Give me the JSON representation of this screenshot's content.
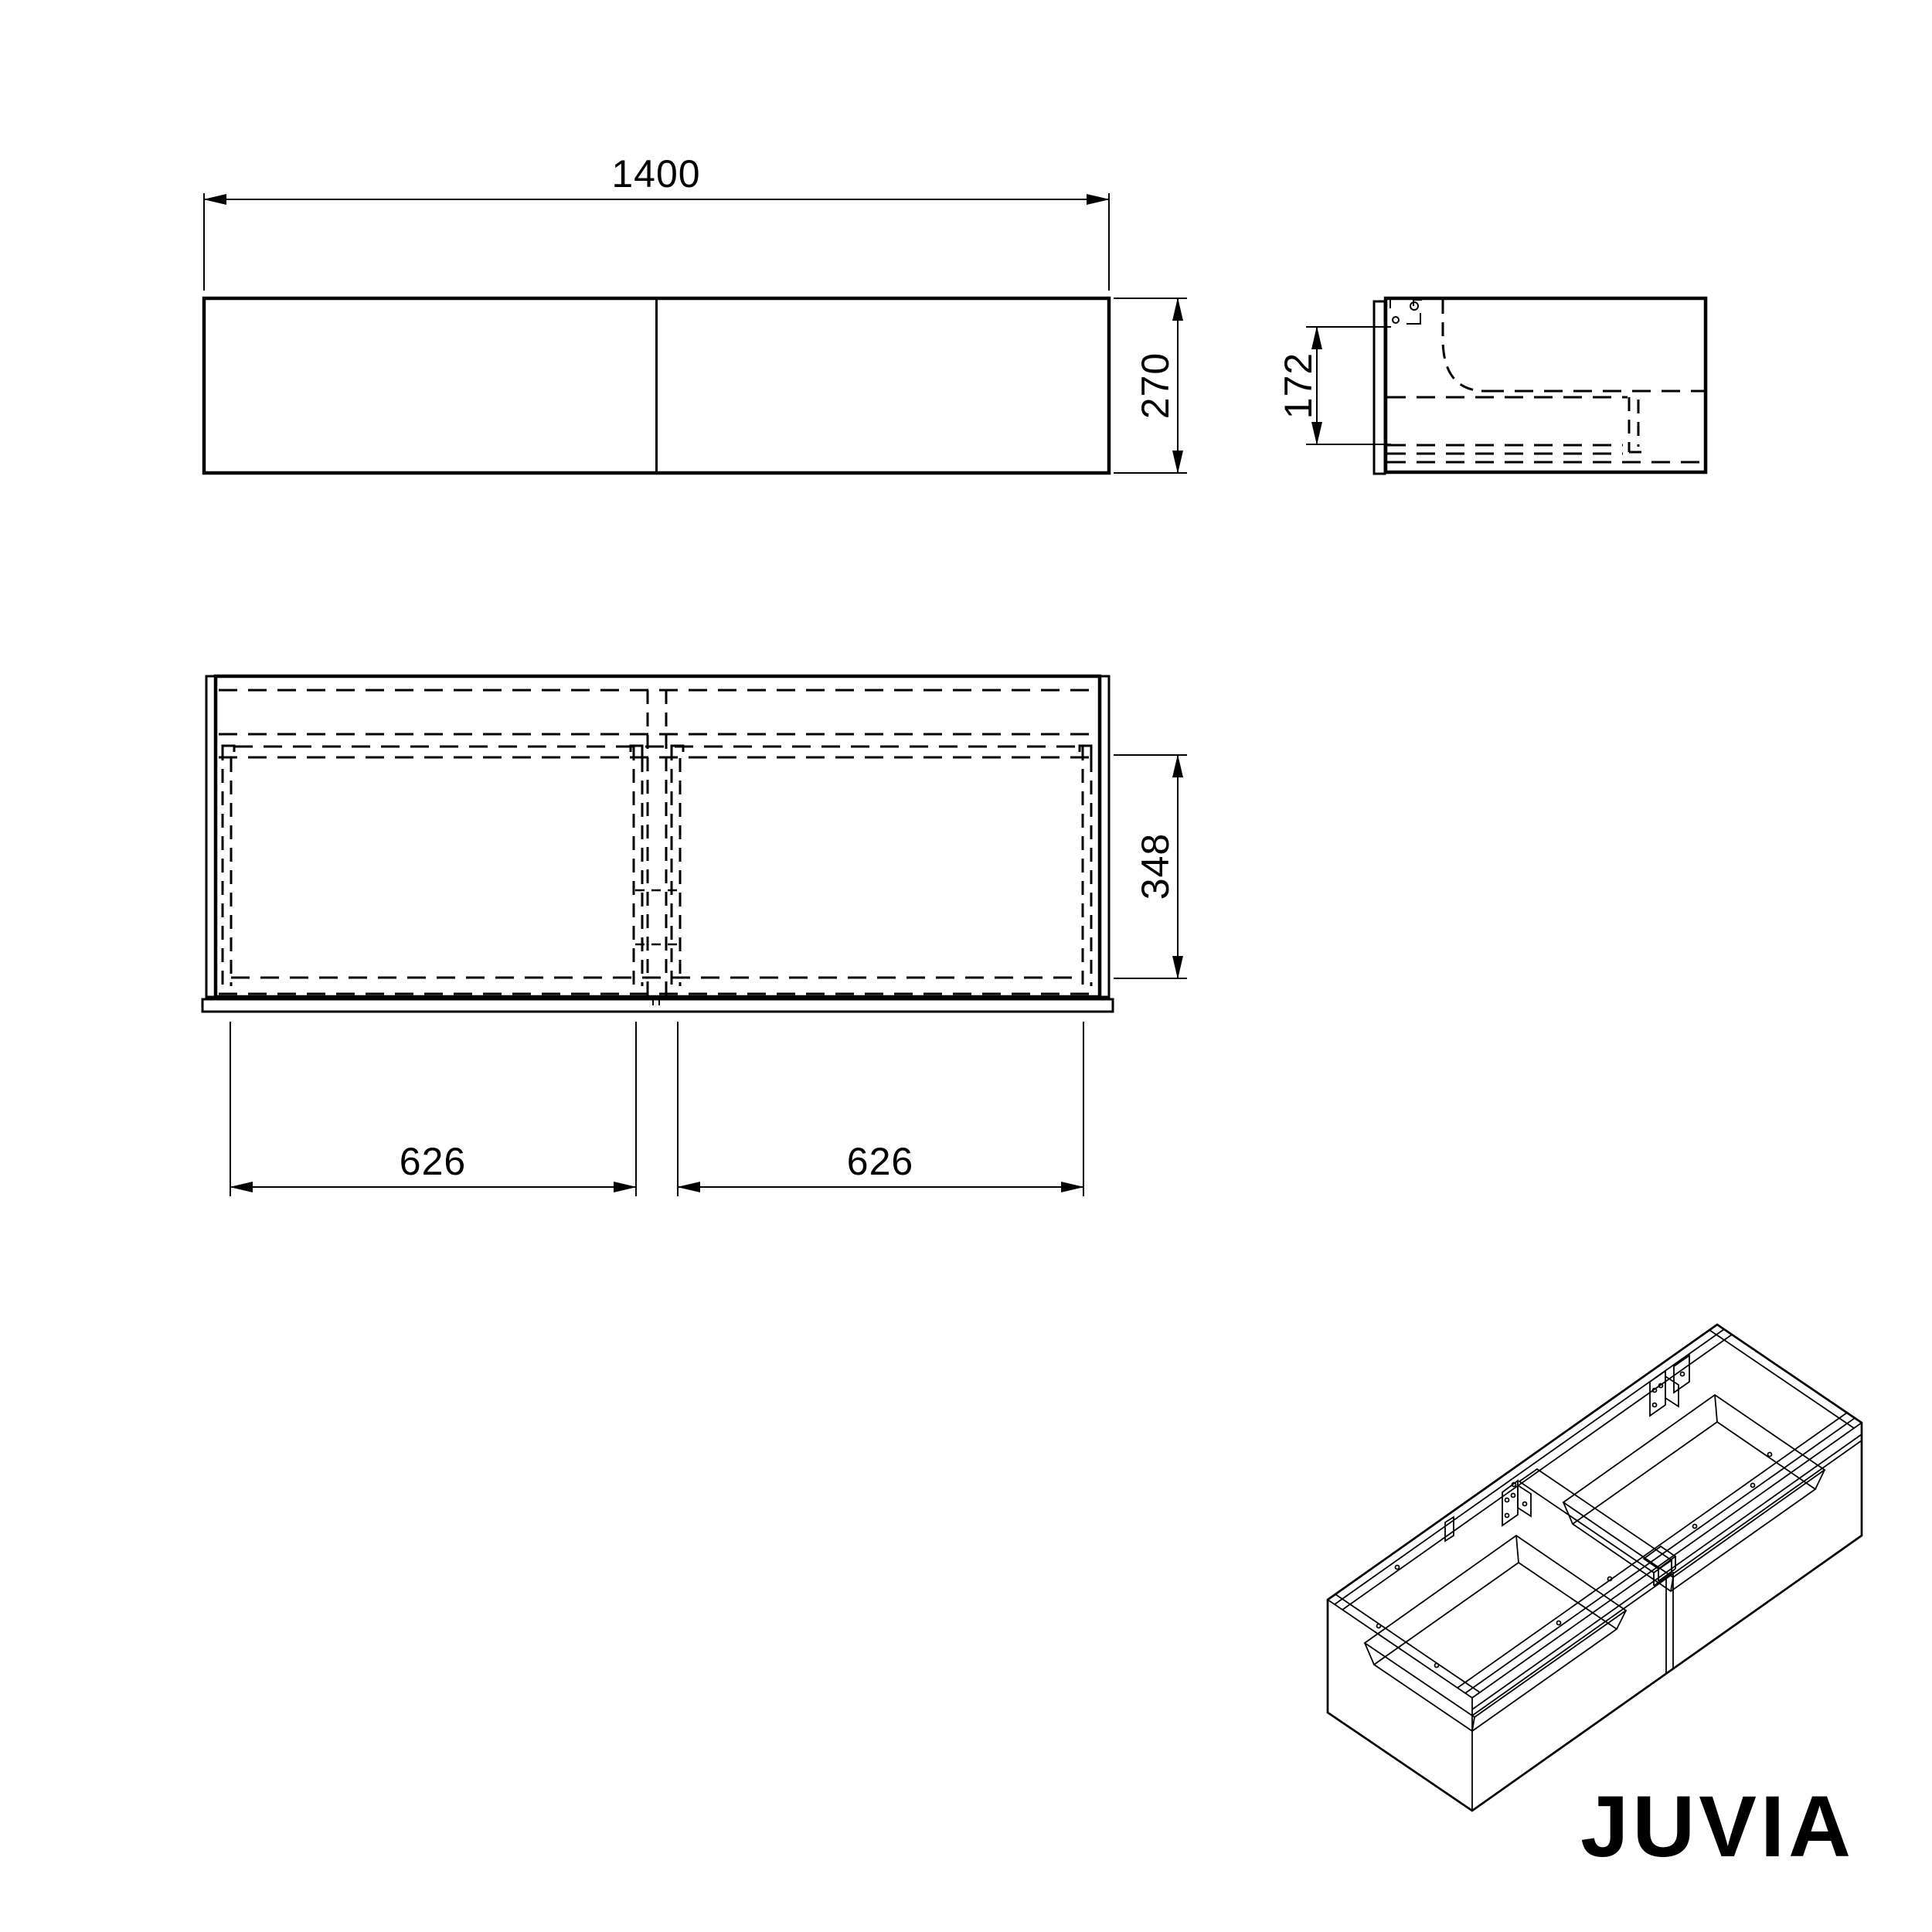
{
  "page": {
    "background": "#ffffff",
    "line_color": "#000000"
  },
  "brand": {
    "wordmark": "JUVIA"
  },
  "views": {
    "front": {
      "label": "front-view",
      "width_dim": "1400",
      "height_dim": "270"
    },
    "side": {
      "label": "side-view",
      "mount_dim": "172"
    },
    "plan": {
      "label": "plan-view",
      "left_drawer_dim": "626",
      "right_drawer_dim": "626",
      "depth_dim": "348"
    }
  }
}
